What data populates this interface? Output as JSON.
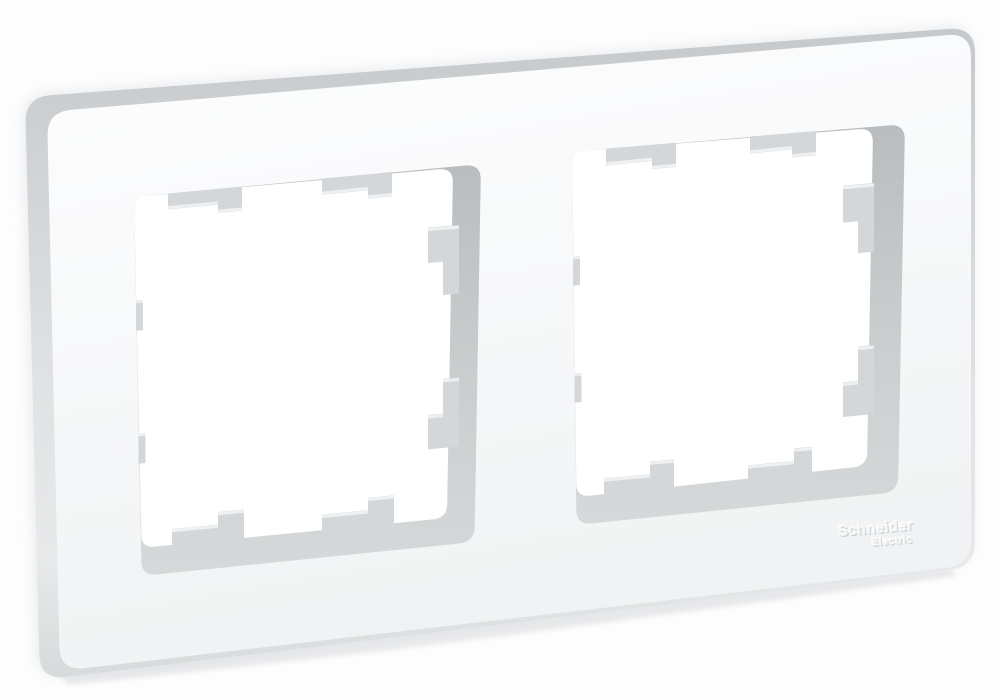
{
  "scene": {
    "background_color": "#fdfdfe",
    "ambient_shadow_color": "#e1e4e6",
    "contact_shadow_color": "#c9cccf"
  },
  "product": {
    "openings_count": 2,
    "brand": {
      "line1": "Schneider",
      "line2": "Electric"
    },
    "colors": {
      "frame_face": "#f8f9fa",
      "frame_top_edge": "#c7cacc",
      "frame_side_edge": "#e6e8ea",
      "recess_wall_dark": "#b9bdbf",
      "recess_wall_light": "#d6d9da",
      "clip_gray": "#d3d7d9",
      "clip_highlight": "#eef0f1",
      "opening_white": "#ffffff",
      "logo_emboss_main": "#f5f6f7",
      "logo_emboss_shadow": "#ccd0d2",
      "logo_emboss_light": "#ffffff"
    }
  }
}
